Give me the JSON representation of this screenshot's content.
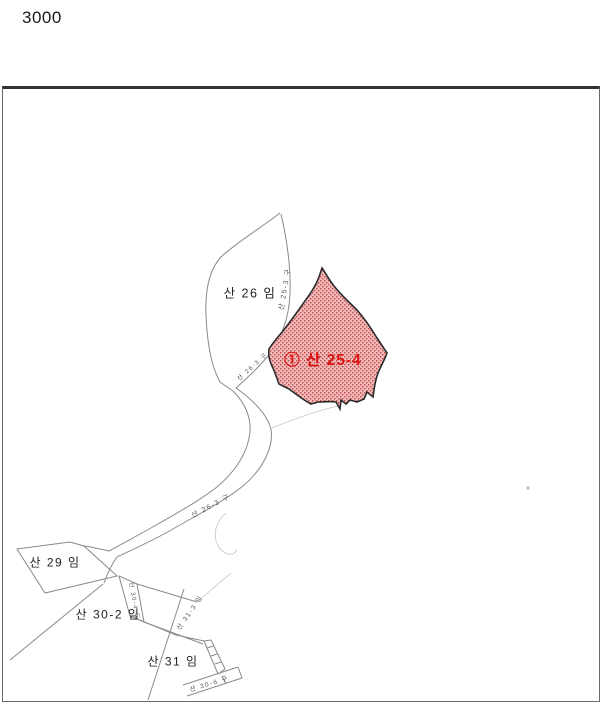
{
  "scale_label": "3000",
  "map": {
    "highlight_parcel": {
      "label": "① 산 25-4",
      "fill": "#f2b9b9",
      "dot_color": "#c24a4a",
      "outline": "#2b2b2b",
      "label_color": "#dd1111"
    },
    "parcel_labels": {
      "san26": "산 26 임",
      "san29": "산 29 임",
      "san30_2": "산 30-2 임",
      "san31": "산 31 임"
    },
    "path_labels": {
      "strip": "산 25-3 구",
      "corridor_upper": "산 26-3 구",
      "corridor_mid": "산 26-3 구",
      "sliver": "산 30-4 도",
      "san31_3": "산 31-3 임",
      "bottom_strip": "산 30-6 구"
    },
    "line_color": "#8a8a8a",
    "frame_color": "#6a6a6a"
  }
}
